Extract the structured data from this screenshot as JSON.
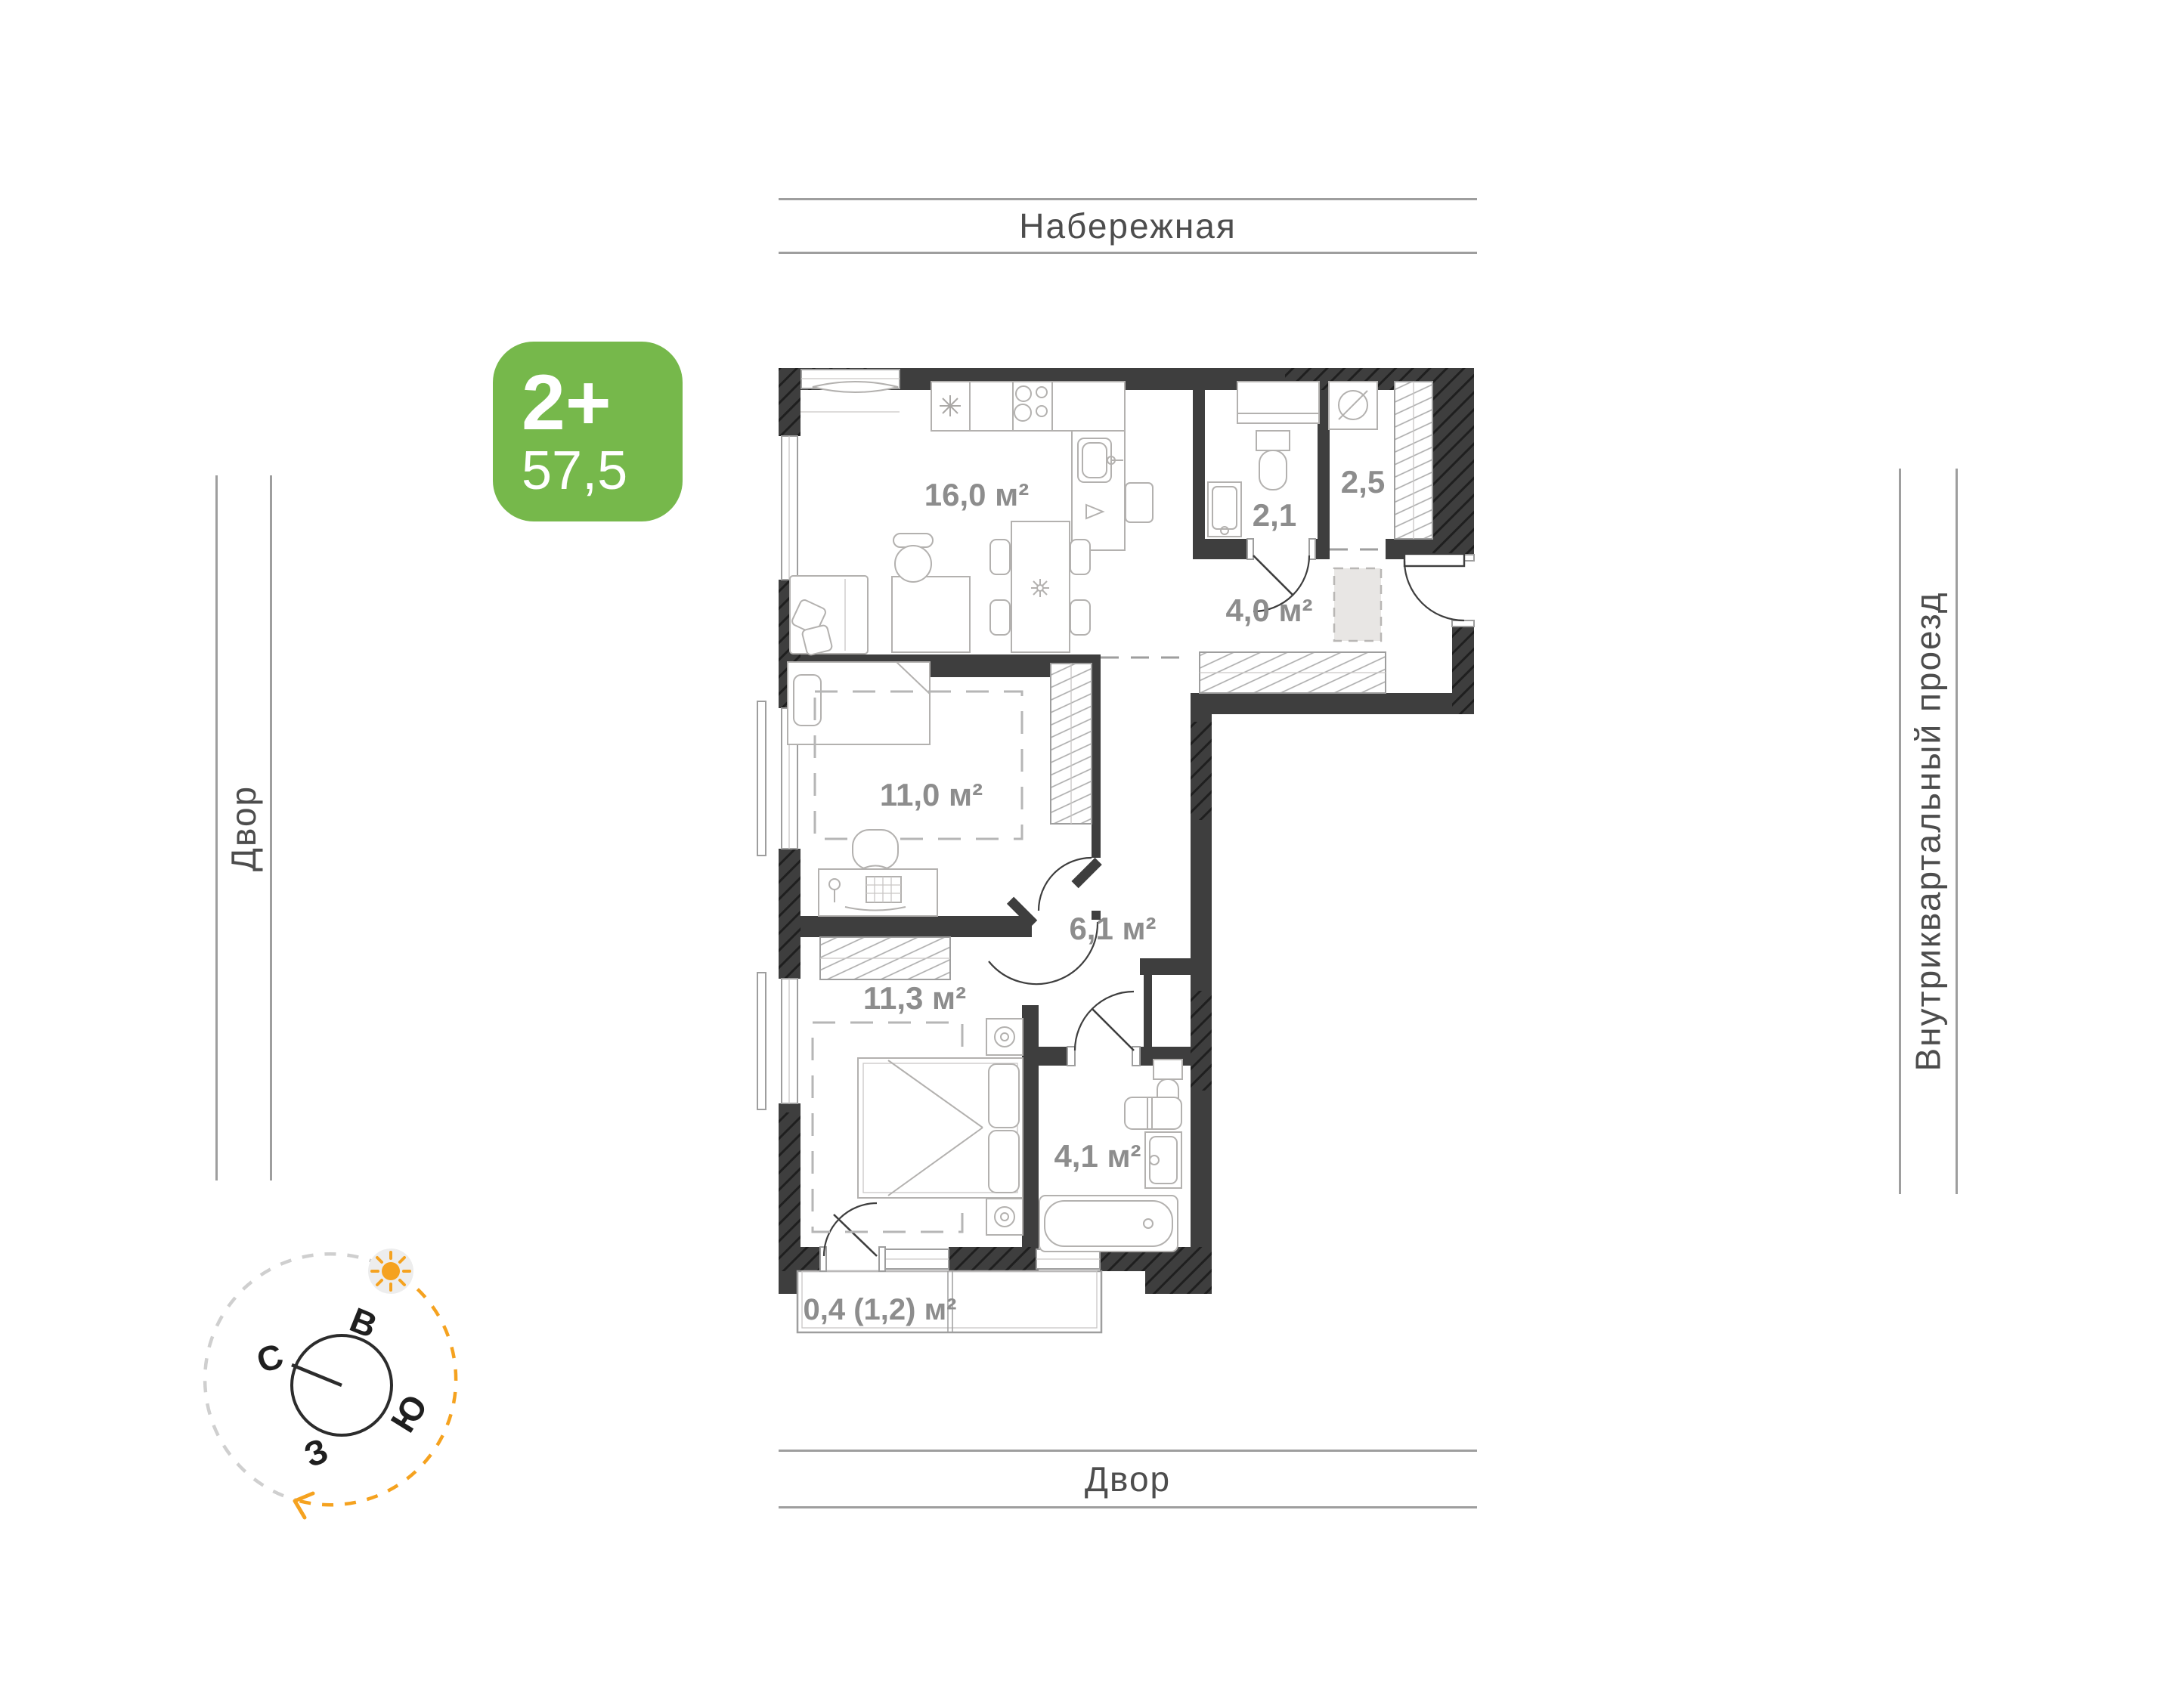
{
  "badge": {
    "type_label": "2+",
    "area_value": "57,5"
  },
  "streets": {
    "top": "Набережная",
    "left": "Двор",
    "right": "Внутриквартальный проезд",
    "bottom": "Двор"
  },
  "rooms": [
    {
      "id": "kitchen-living",
      "label": "16,0 м²"
    },
    {
      "id": "bathroom-small",
      "label": "2,1"
    },
    {
      "id": "closet",
      "label": "2,5"
    },
    {
      "id": "hallway-entry",
      "label": "4,0 м²"
    },
    {
      "id": "bedroom-1",
      "label": "11,0 м²"
    },
    {
      "id": "hallway-inner",
      "label": "6,1 м²"
    },
    {
      "id": "bedroom-2",
      "label": "11,3 м²"
    },
    {
      "id": "bathroom-main",
      "label": "4,1 м²"
    },
    {
      "id": "balcony",
      "label": "0,4 (1,2) м²"
    }
  ],
  "compass": {
    "east": "В",
    "north": "С",
    "south": "Ю",
    "west": "З"
  },
  "colors": {
    "badge_green": "#76b84b",
    "sun_orange": "#f5a21f",
    "wall_dark": "#3e3e3e",
    "room_label_gray": "#8d8d8d",
    "street_line_gray": "#9e9e9e"
  }
}
